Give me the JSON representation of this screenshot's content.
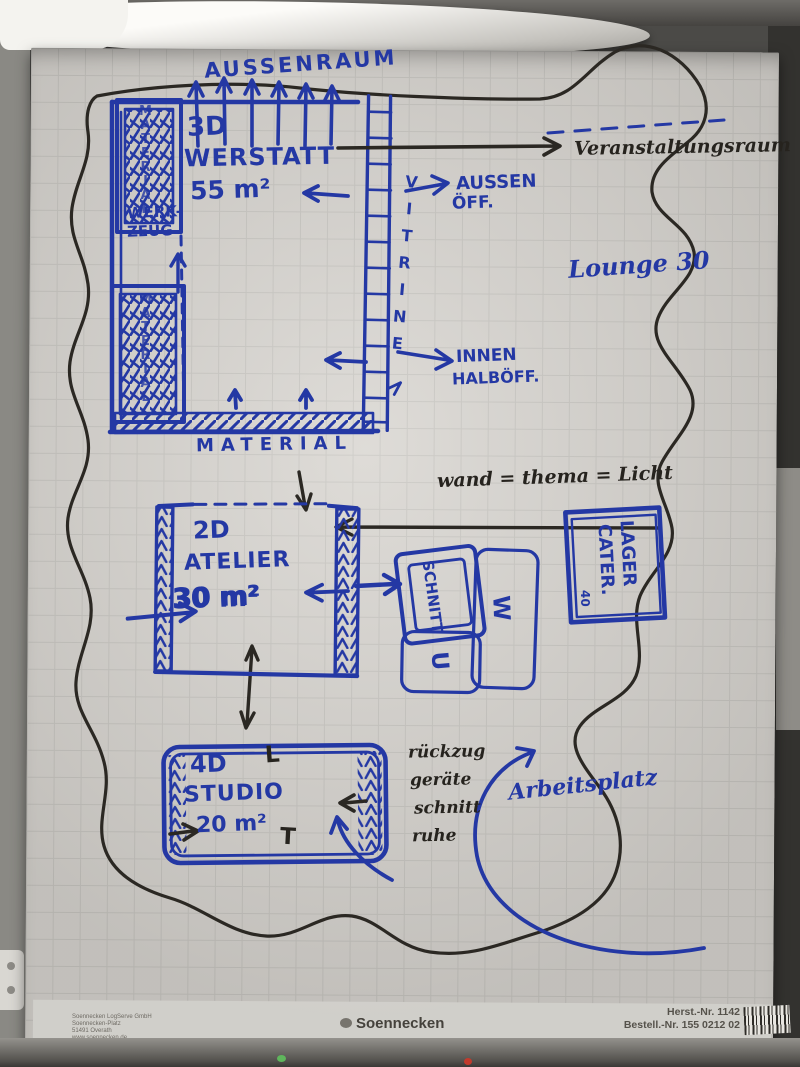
{
  "colors": {
    "marker_blue": "#2438a4",
    "marker_black": "#26231e",
    "sheet": "#d8d5d0"
  },
  "sketch": {
    "outdoor_label": "AUSSENRAUM",
    "workshop": {
      "l1": "3D",
      "l2": "WERSTATT",
      "l3": "55 m²"
    },
    "shelf_vertical_label": "MATERIAL",
    "werkzeug": {
      "l1": "WERK-",
      "l2": "ZEUG"
    },
    "vitrine_label": "VITRINE",
    "aussen_oeff": {
      "l1": "AUSSEN",
      "l2": "ÖFF."
    },
    "innen_halboeff": {
      "l1": "INNEN",
      "l2": "HALBÖFF."
    },
    "material_wall_label": "MATERIAL",
    "veranstaltungsraum": "Veranstaltungsraum",
    "lounge": "Lounge 30",
    "wand_thema": "wand = thema = Licht",
    "atelier": {
      "l1": "2D",
      "l2": "ATELIER",
      "l3": "30 m²"
    },
    "schnitt_label": "SCHNITT",
    "w_label": "W",
    "u_label": "U",
    "lager": {
      "l1": "LAGER",
      "l2": "CATER.",
      "small": "40"
    },
    "studio": {
      "l1": "4D",
      "l2": "STUDIO",
      "l3": "20 m²"
    },
    "studio_marks": {
      "left_mark": "L",
      "bottom_mark": "T"
    },
    "rueckzug": {
      "l1": "rückzug",
      "l2": "geräte",
      "l3": "schnitt",
      "l4": "ruhe"
    },
    "arbeitsplatz": "Arbeitsplatz"
  },
  "footer": {
    "imprint": [
      "Soennecken LogServe GmbH",
      "Soennecken-Platz",
      "51491 Overath",
      "www.soennecken.de"
    ],
    "logo": "Soennecken",
    "herst_nr": "Herst.-Nr. 1142",
    "bestell_nr": "Bestell.-Nr. 155 0212 02"
  }
}
